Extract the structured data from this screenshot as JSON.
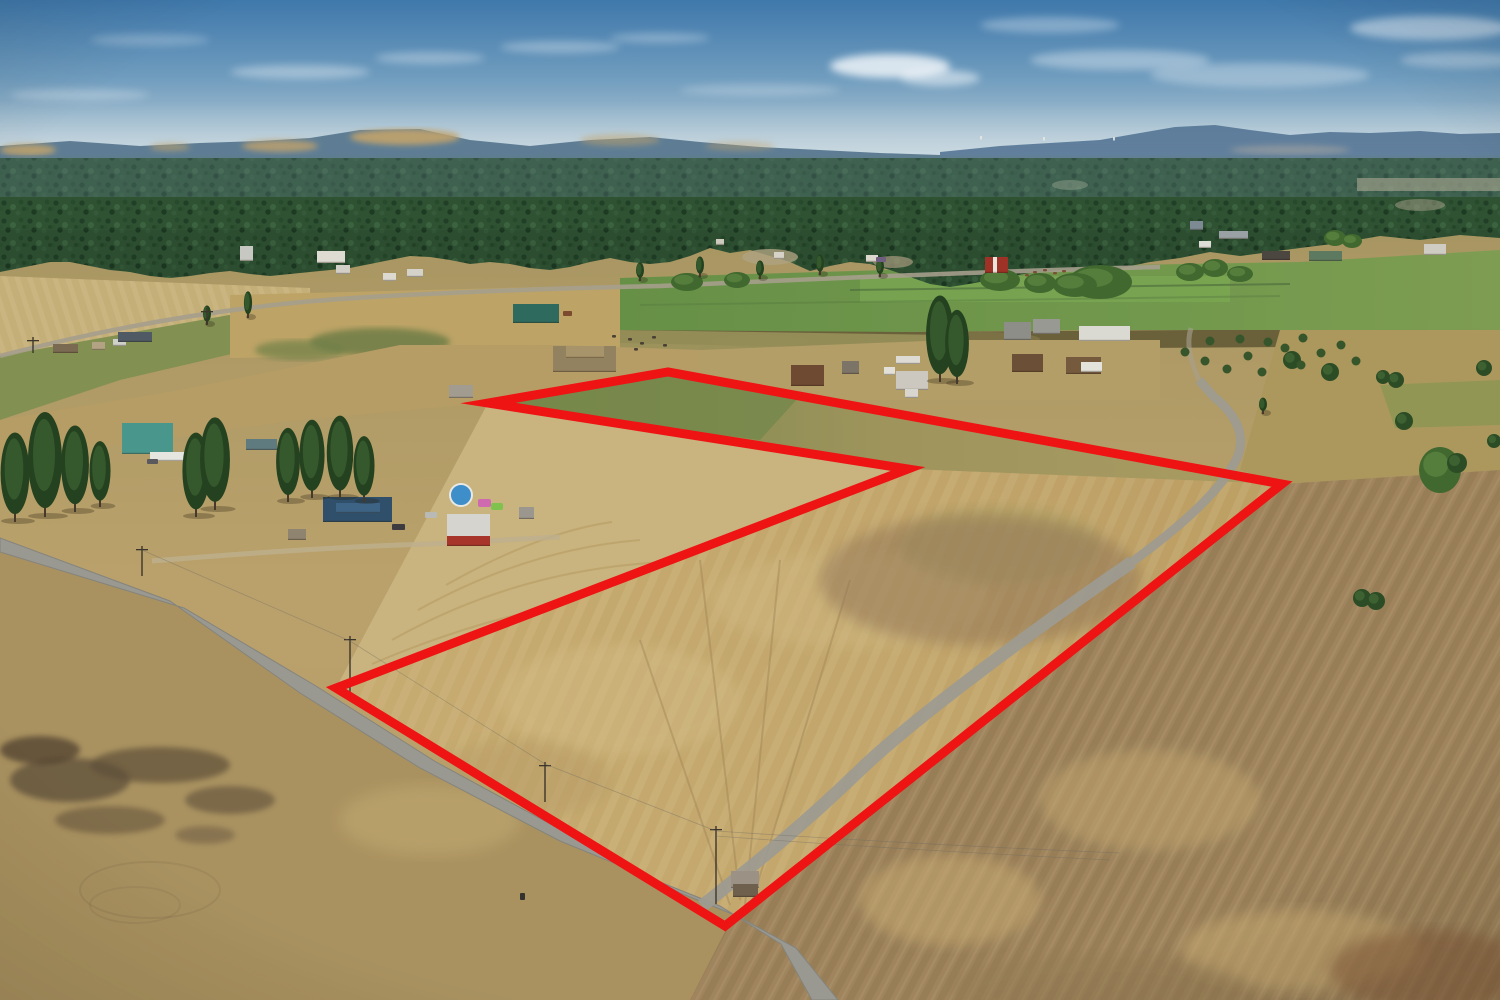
{
  "scene": {
    "kind": "aerial-drone-photograph",
    "subject": "rural farmland acreage with red property boundary outline, pine forest, distant hills and mountains",
    "palette": {
      "sky_top": "#3f78ab",
      "sky_horizon": "#c2d2da",
      "mountains": "#4f7090",
      "hills": "#5e7d94",
      "hill_wheat": "#c2a36b",
      "forest": "#2f5233",
      "pasture_green": "#6f9b4c",
      "field_tan": "#c9ae6d",
      "field_gold": "#d2b475",
      "plowed_brown": "#a98d63",
      "wedge_tan": "#d6bf86",
      "road_gray": "#a3a39b"
    },
    "boundary": {
      "color": "#ee1414",
      "stroke_width": 9,
      "points": "488,403 668,372 1282,484 725,926 336,688 908,469"
    },
    "roads": {
      "main_points": "0,538 170,601 300,693 420,768 560,841 665,884 720,906 781,944 812,1000 838,1000 796,948 737,916 680,893 576,838 436,762 316,686 184,608 0,552",
      "spur_lower_d": "M 702,906 C 750,868 800,828 858,772 C 918,714 1045,622 1132,562",
      "spur_upper_d": "M 1132,562 C 1185,523 1222,489 1237,458 C 1246,438 1238,416 1214,397 L 1199,380",
      "north_track_d": "M 1199,380 C 1190,360 1186,344 1191,328",
      "distant_d": "M 0,356 C 100,330 200,312 302,302 C 380,295 520,289 660,286 C 810,279 990,271 1160,267",
      "driveway_d": "M 152,561 C 260,552 360,546 430,544 L 560,537"
    },
    "buildings": [
      [
        53,
        344,
        25,
        9,
        "#7a6a52"
      ],
      [
        92,
        342,
        13,
        8,
        "#b3a384"
      ],
      [
        113,
        339,
        13,
        7,
        "#d0d0ca"
      ],
      [
        118,
        332,
        34,
        10,
        "#4f5a64"
      ],
      [
        240,
        246,
        13,
        15,
        "#c8c8c2"
      ],
      [
        317,
        251,
        28,
        12,
        "#dedbd3"
      ],
      [
        336,
        265,
        14,
        9,
        "#d2cfc7"
      ],
      [
        383,
        273,
        13,
        8,
        "#dcd9d1"
      ],
      [
        407,
        269,
        16,
        8,
        "#d5d2ca"
      ],
      [
        513,
        304,
        46,
        19,
        "#2e6b5e"
      ],
      [
        553,
        346,
        63,
        26,
        "#93825f"
      ],
      [
        566,
        346,
        38,
        12,
        "#a8946a"
      ],
      [
        449,
        385,
        24,
        13,
        "#a29c90"
      ],
      [
        122,
        423,
        51,
        31,
        "#49978c"
      ],
      [
        150,
        452,
        38,
        9,
        "#e6e6e0"
      ],
      [
        246,
        439,
        31,
        11,
        "#5f7b80"
      ],
      [
        323,
        497,
        69,
        25,
        "#2f4f6b"
      ],
      [
        336,
        503,
        44,
        10,
        "#3e6485"
      ],
      [
        288,
        529,
        18,
        11,
        "#8f8470"
      ],
      [
        447,
        514,
        43,
        27,
        "#d6d4cf"
      ],
      [
        447,
        536,
        43,
        10,
        "#a8352b"
      ],
      [
        519,
        507,
        15,
        12,
        "#9c978e"
      ],
      [
        791,
        365,
        33,
        21,
        "#6f4a32"
      ],
      [
        842,
        361,
        17,
        13,
        "#7d7468"
      ],
      [
        884,
        367,
        11,
        8,
        "#e2e0d9"
      ],
      [
        896,
        371,
        32,
        19,
        "#ccc8bf"
      ],
      [
        896,
        356,
        24,
        8,
        "#dddbd3"
      ],
      [
        905,
        389,
        13,
        9,
        "#d8d6cf"
      ],
      [
        985,
        257,
        23,
        16,
        "#9f3227"
      ],
      [
        993,
        257,
        4,
        16,
        "#e8e5dd"
      ],
      [
        1004,
        322,
        27,
        18,
        "#8e8e89"
      ],
      [
        1033,
        319,
        27,
        15,
        "#999993"
      ],
      [
        1079,
        326,
        51,
        15,
        "#dadad3"
      ],
      [
        1012,
        354,
        31,
        18,
        "#6c4f37"
      ],
      [
        1066,
        357,
        35,
        17,
        "#755a3e"
      ],
      [
        1081,
        362,
        21,
        10,
        "#e3e3dc"
      ],
      [
        1190,
        221,
        13,
        9,
        "#7d8a93"
      ],
      [
        1219,
        231,
        29,
        8,
        "#9aa1a4"
      ],
      [
        1199,
        241,
        12,
        7,
        "#deded7"
      ],
      [
        1262,
        251,
        28,
        9,
        "#4c4641"
      ],
      [
        1309,
        251,
        33,
        10,
        "#5d7a61"
      ],
      [
        1424,
        244,
        22,
        11,
        "#cfccc4"
      ],
      [
        716,
        239,
        8,
        6,
        "#cfcabe"
      ],
      [
        774,
        252,
        10,
        7,
        "#d6d2c8"
      ],
      [
        866,
        255,
        12,
        7,
        "#dcd8ce"
      ],
      [
        731,
        871,
        28,
        17,
        "#9b9285"
      ],
      [
        733,
        884,
        25,
        13,
        "#6f604d"
      ]
    ],
    "vehicles": [
      [
        392,
        524,
        13,
        6,
        "#3c3c40"
      ],
      [
        425,
        512,
        12,
        6,
        "#b9b9b5"
      ],
      [
        147,
        459,
        11,
        5,
        "#5a5a5e"
      ],
      [
        876,
        257,
        10,
        5,
        "#6f5e80"
      ],
      [
        563,
        311,
        9,
        5,
        "#7c4a2e"
      ],
      [
        520,
        893,
        5,
        7,
        "#33322f"
      ]
    ],
    "trees": {
      "pines": [
        [
          196,
          515,
          80
        ],
        [
          215,
          508,
          88
        ],
        [
          288,
          500,
          70
        ],
        [
          312,
          496,
          74
        ],
        [
          340,
          496,
          78
        ],
        [
          364,
          500,
          62
        ],
        [
          15,
          520,
          85
        ],
        [
          45,
          515,
          100
        ],
        [
          75,
          510,
          82
        ],
        [
          100,
          505,
          62
        ],
        [
          940,
          380,
          82
        ],
        [
          957,
          382,
          70
        ],
        [
          248,
          316,
          24
        ],
        [
          207,
          323,
          17
        ],
        [
          640,
          279,
          16
        ],
        [
          700,
          275,
          18
        ],
        [
          760,
          277,
          16
        ],
        [
          820,
          273,
          18
        ],
        [
          880,
          275,
          16
        ],
        [
          1263,
          412,
          14
        ]
      ],
      "bushes": [
        [
          1292,
          360,
          9
        ],
        [
          1330,
          372,
          9
        ],
        [
          1383,
          377,
          7
        ],
        [
          1396,
          380,
          8
        ],
        [
          1484,
          368,
          8
        ],
        [
          1404,
          421,
          9
        ],
        [
          1494,
          441,
          7
        ],
        [
          1362,
          598,
          9
        ],
        [
          1376,
          601,
          9
        ],
        [
          1457,
          463,
          10
        ]
      ],
      "canopies": [
        [
          1100,
          282,
          32,
          17
        ],
        [
          1000,
          280,
          20,
          11
        ],
        [
          1040,
          283,
          16,
          10
        ],
        [
          1075,
          285,
          22,
          12
        ],
        [
          1190,
          272,
          14,
          9
        ],
        [
          1215,
          268,
          13,
          9
        ],
        [
          1240,
          274,
          13,
          8
        ],
        [
          1335,
          238,
          11,
          8
        ],
        [
          1352,
          241,
          10,
          7
        ],
        [
          1440,
          470,
          21,
          23
        ],
        [
          687,
          282,
          16,
          9
        ],
        [
          737,
          280,
          13,
          8
        ]
      ],
      "rows": [
        [
          1185,
          352
        ],
        [
          1205,
          361
        ],
        [
          1227,
          369
        ],
        [
          1248,
          356
        ],
        [
          1262,
          372
        ],
        [
          1285,
          348
        ],
        [
          1301,
          365
        ],
        [
          1321,
          353
        ],
        [
          1341,
          345
        ],
        [
          1356,
          361
        ],
        [
          1240,
          339
        ],
        [
          1268,
          342
        ],
        [
          1210,
          341
        ],
        [
          1303,
          338
        ]
      ]
    },
    "animals": {
      "cattle": [
        [
          628,
          338
        ],
        [
          640,
          342
        ],
        [
          652,
          336
        ],
        [
          663,
          344
        ],
        [
          634,
          348
        ],
        [
          612,
          335
        ]
      ],
      "horses": [
        [
          1033,
          271
        ],
        [
          1043,
          269
        ],
        [
          1053,
          272
        ],
        [
          1062,
          270
        ],
        [
          1025,
          274
        ]
      ]
    },
    "power_poles": [
      [
        142,
        546,
        30
      ],
      [
        350,
        636,
        56
      ],
      [
        716,
        826,
        78
      ],
      [
        33,
        337,
        16
      ],
      [
        207,
        308,
        16
      ],
      [
        545,
        762,
        40
      ]
    ],
    "details": {
      "pool": {
        "cx": 461,
        "cy": 495,
        "r": 11,
        "water": "#3e8ec9"
      },
      "bounce_house": [
        [
          478,
          499,
          13,
          8,
          "#d06ab0"
        ],
        [
          491,
          503,
          12,
          7,
          "#7fc24d"
        ]
      ],
      "horizon_dots": [
        [
          980,
          136
        ],
        [
          1043,
          137
        ],
        [
          1113,
          137
        ]
      ]
    }
  }
}
